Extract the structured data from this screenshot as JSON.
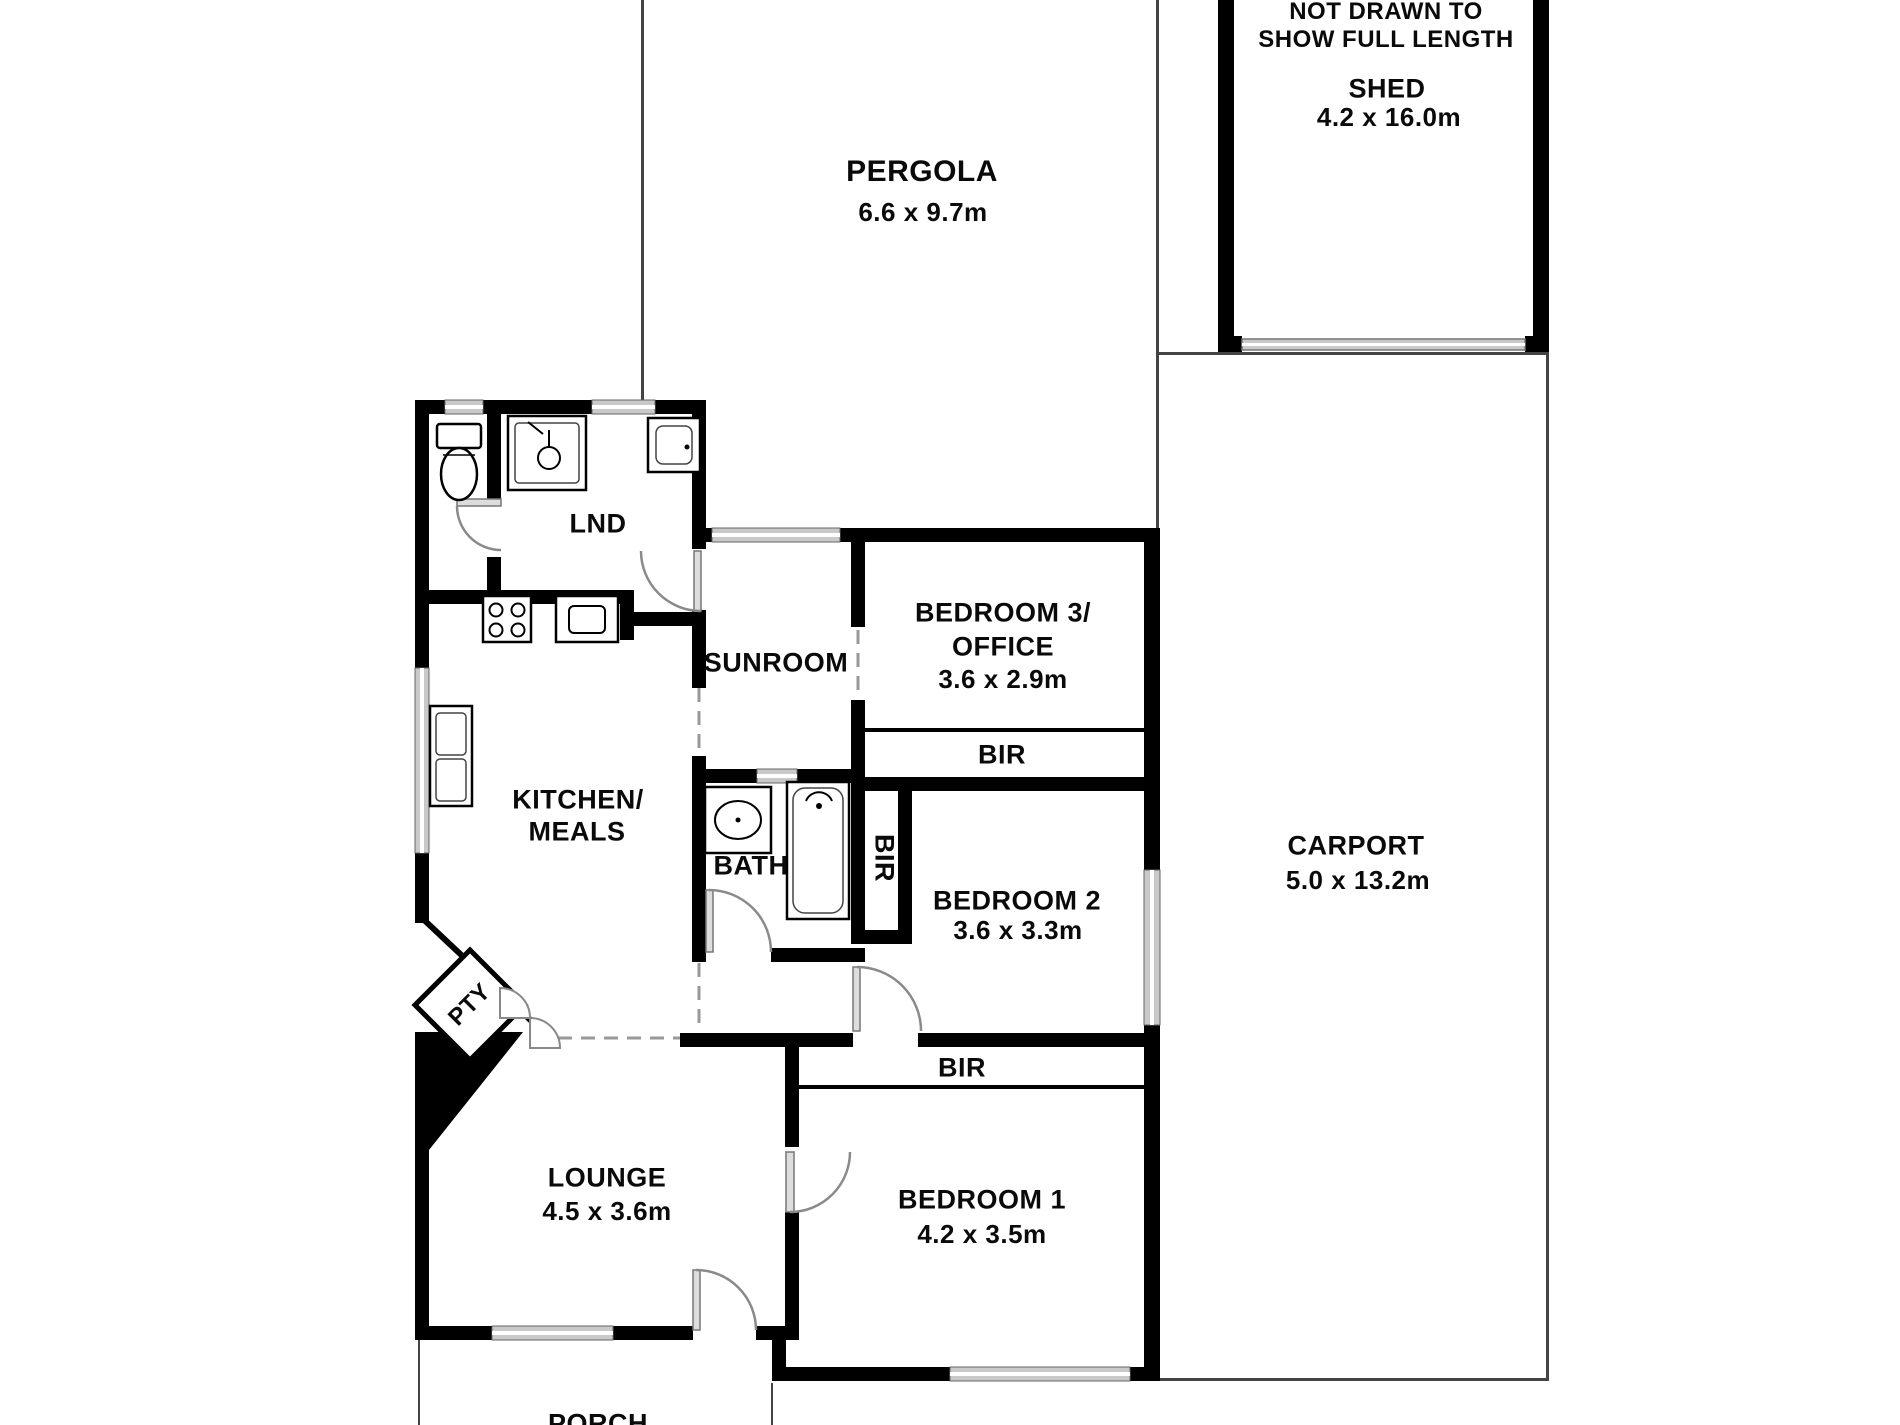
{
  "plan": {
    "outdoor": {
      "pergola": {
        "name": "PERGOLA",
        "dims": "6.6 x 9.7m"
      },
      "shed": {
        "note_line1": "NOT DRAWN TO",
        "note_line2": "SHOW FULL LENGTH",
        "name": "SHED",
        "dims": "4.2 x 16.0m"
      },
      "carport": {
        "name": "CARPORT",
        "dims": "5.0 x 13.2m"
      },
      "porch": {
        "name": "PORCH"
      }
    },
    "rooms": {
      "laundry": {
        "name": "LND"
      },
      "sunroom": {
        "name": "SUNROOM"
      },
      "bedroom3": {
        "name_line1": "BEDROOM 3/",
        "name_line2": "OFFICE",
        "dims": "3.6 x 2.9m"
      },
      "bir_bedroom3": {
        "name": "BIR"
      },
      "bath": {
        "name": "BATH"
      },
      "bir_bedroom2": {
        "name": "BIR"
      },
      "bedroom2": {
        "name": "BEDROOM 2",
        "dims": "3.6 x 3.3m"
      },
      "kitchen": {
        "name_line1": "KITCHEN/",
        "name_line2": "MEALS"
      },
      "pantry": {
        "name": "PTY"
      },
      "bir_bedroom1": {
        "name": "BIR"
      },
      "lounge": {
        "name": "LOUNGE",
        "dims": "4.5 x 3.6m"
      },
      "bedroom1": {
        "name": "BEDROOM 1",
        "dims": "4.2 x 3.5m"
      }
    },
    "colors": {
      "wall": "#000000",
      "window": "#c9c9c9",
      "dashed_opening": "#999999",
      "thin_outline": "#444444",
      "background": "#ffffff"
    }
  }
}
